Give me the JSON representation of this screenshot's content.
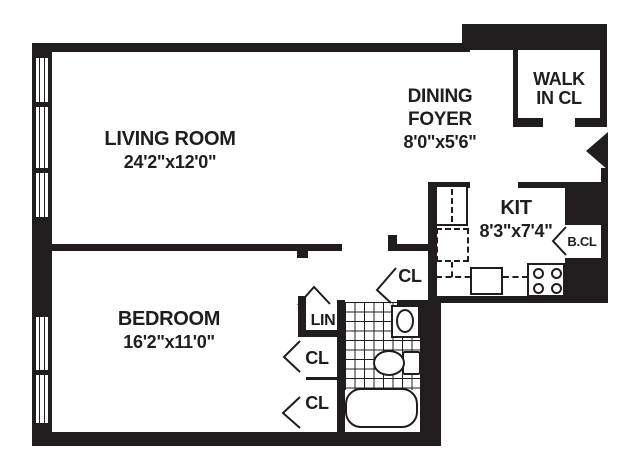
{
  "palette": {
    "ink": "#211d1e",
    "paper": "#ffffff"
  },
  "rooms": {
    "living_room": {
      "name": "LIVING ROOM",
      "dims": "24'2\"x12'0\""
    },
    "dining_foyer": {
      "name": "DINING FOYER",
      "dims": "8'0\"x5'6\""
    },
    "kitchen": {
      "name": "KIT",
      "dims": "8'3\"x7'4\""
    },
    "bedroom": {
      "name": "BEDROOM",
      "dims": "16'2\"x11'0\""
    },
    "walk_in_closet": {
      "name": "WALK IN CL"
    },
    "broom_closet": {
      "name": "B.CL"
    },
    "linen_closet": {
      "name": "LIN"
    },
    "hall_closet": {
      "name": "CL"
    },
    "bedroom_closet_1": {
      "name": "CL"
    },
    "bedroom_closet_2": {
      "name": "CL"
    }
  }
}
